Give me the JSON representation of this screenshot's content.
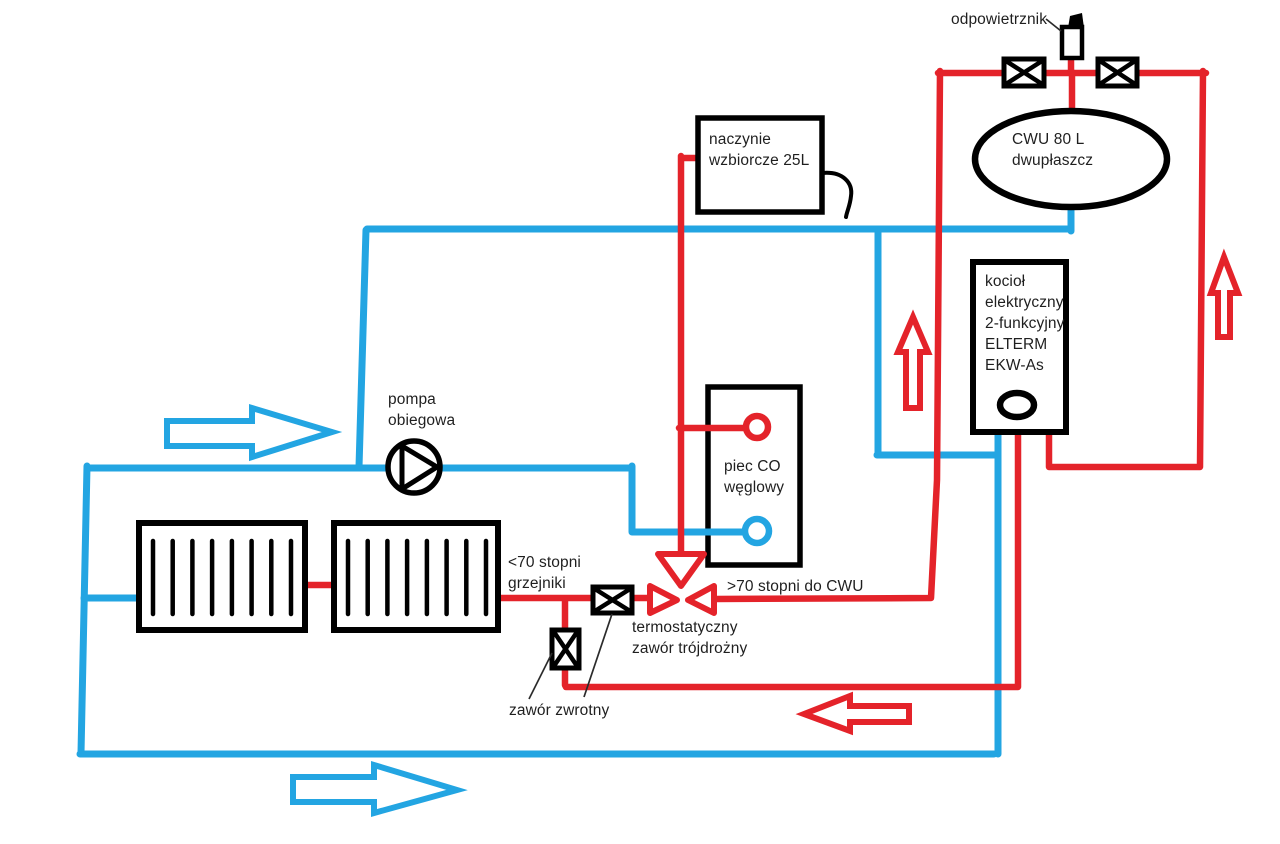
{
  "colors": {
    "hot": "#e4232a",
    "cold": "#23a5e2",
    "ink": "#000000",
    "text": "#1f1f1f",
    "bg": "#ffffff"
  },
  "labels": {
    "air_vent": "odpowietrznik",
    "dhw_tank": "CWU 80 L\ndwupłaszcz",
    "expansion_vessel": "naczynie\nwzbiorcze 25L",
    "electric_boiler": "kocioł\nelektryczny\n2-funkcyjny\nELTERM\nEKW-As",
    "circulation_pump": "pompa\nobiegowa",
    "coal_stove": "piec CO\nwęglowy",
    "radiators_temp": "<70 stopni\ngrzejniki",
    "dhw_temp": ">70 stopni do CWU",
    "three_way_valve": "termostatyczny\nzawór trójdrożny",
    "check_valve": "zawór zwrotny"
  }
}
